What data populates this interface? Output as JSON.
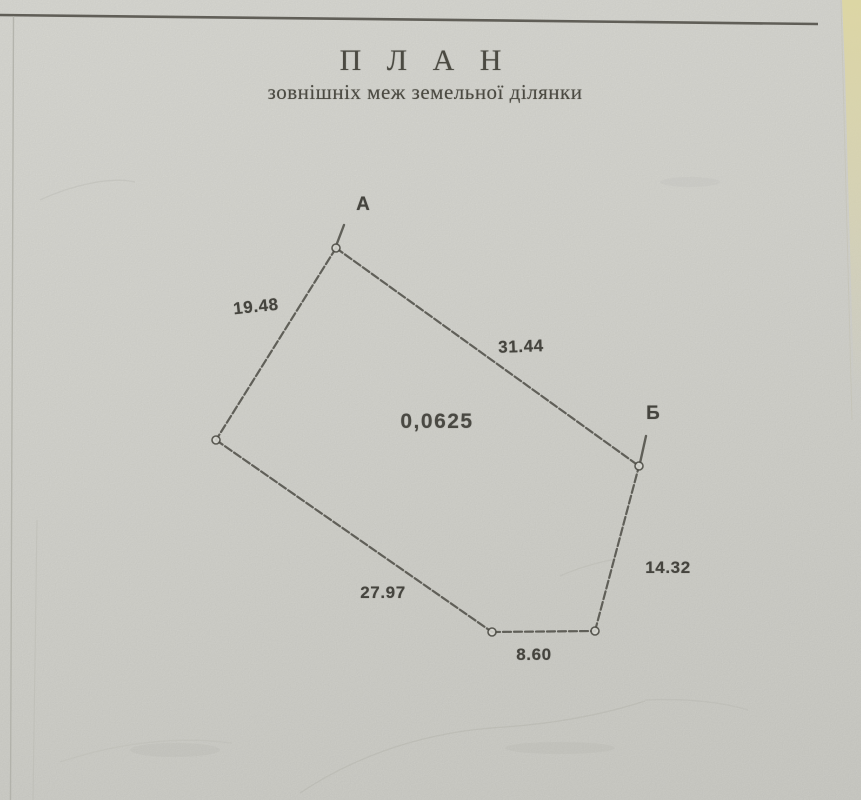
{
  "document": {
    "title": "П Л А Н",
    "subtitle": "зовнішніх меж земельної ділянки"
  },
  "plan": {
    "area_label": {
      "text": "0,0625",
      "x": 437,
      "y": 422
    },
    "vertex_points": [
      {
        "x": 336,
        "y": 248
      },
      {
        "x": 216,
        "y": 440
      },
      {
        "x": 492,
        "y": 632
      },
      {
        "x": 595,
        "y": 631
      },
      {
        "x": 639,
        "y": 466
      }
    ],
    "vertex_labels": [
      {
        "text": "А",
        "x": 363,
        "y": 205
      },
      {
        "text": "Б",
        "x": 653,
        "y": 414
      }
    ],
    "ticks": [
      {
        "x1": 336,
        "y1": 246,
        "x2": 344,
        "y2": 225
      },
      {
        "x1": 640,
        "y1": 463,
        "x2": 646,
        "y2": 436
      }
    ],
    "edges": [
      {
        "from": 0,
        "to": 1,
        "label": {
          "text": "19.48",
          "x": 256,
          "y": 307,
          "rotate": -6
        }
      },
      {
        "from": 0,
        "to": 4,
        "label": {
          "text": "31.44",
          "x": 521,
          "y": 347,
          "rotate": -2
        }
      },
      {
        "from": 1,
        "to": 2,
        "label": {
          "text": "27.97",
          "x": 383,
          "y": 593,
          "rotate": 0
        }
      },
      {
        "from": 2,
        "to": 3,
        "label": {
          "text": "8.60",
          "x": 534,
          "y": 655,
          "rotate": 0
        }
      },
      {
        "from": 3,
        "to": 4,
        "label": {
          "text": "14.32",
          "x": 668,
          "y": 568,
          "rotate": 0
        }
      }
    ]
  },
  "colors": {
    "paper": "#d8d8d2",
    "ink": "#4e4d46",
    "text": "#45443e",
    "page_edge_cream": "#ddd6a2"
  }
}
